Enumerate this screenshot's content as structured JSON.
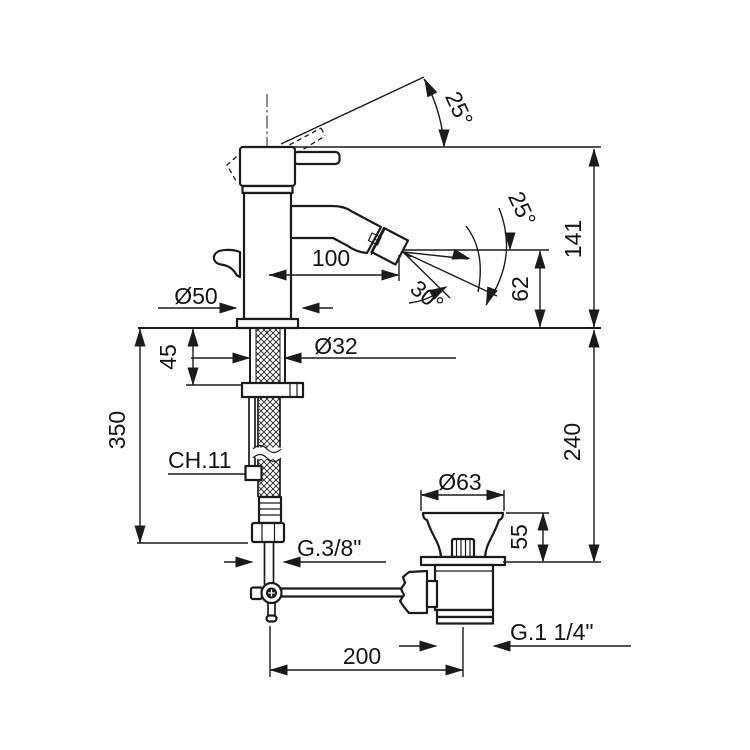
{
  "drawing": {
    "type": "technical-dimension-drawing",
    "subject": "single-lever bidet mixer with swivel aerator and pop-up waste",
    "background": "#ffffff",
    "line_color": "#1b1b1b",
    "labels": {
      "handle_angle": "25°",
      "spray_angle_large": "25°",
      "spray_angle_small": "30°",
      "spout_reach": "100",
      "spout_height": "62",
      "top_height": "141",
      "base_diameter": "Ø50",
      "shank_diameter": "Ø32",
      "shank_depth": "45",
      "hose_length": "350",
      "wrench_size": "CH.11",
      "below_deck_depth": "240",
      "supply_thread": "G.3/8\"",
      "waste_cap_diameter": "Ø63",
      "waste_height": "55",
      "waste_thread": "G.1 1/4\"",
      "rod_to_waste_distance": "200"
    }
  }
}
